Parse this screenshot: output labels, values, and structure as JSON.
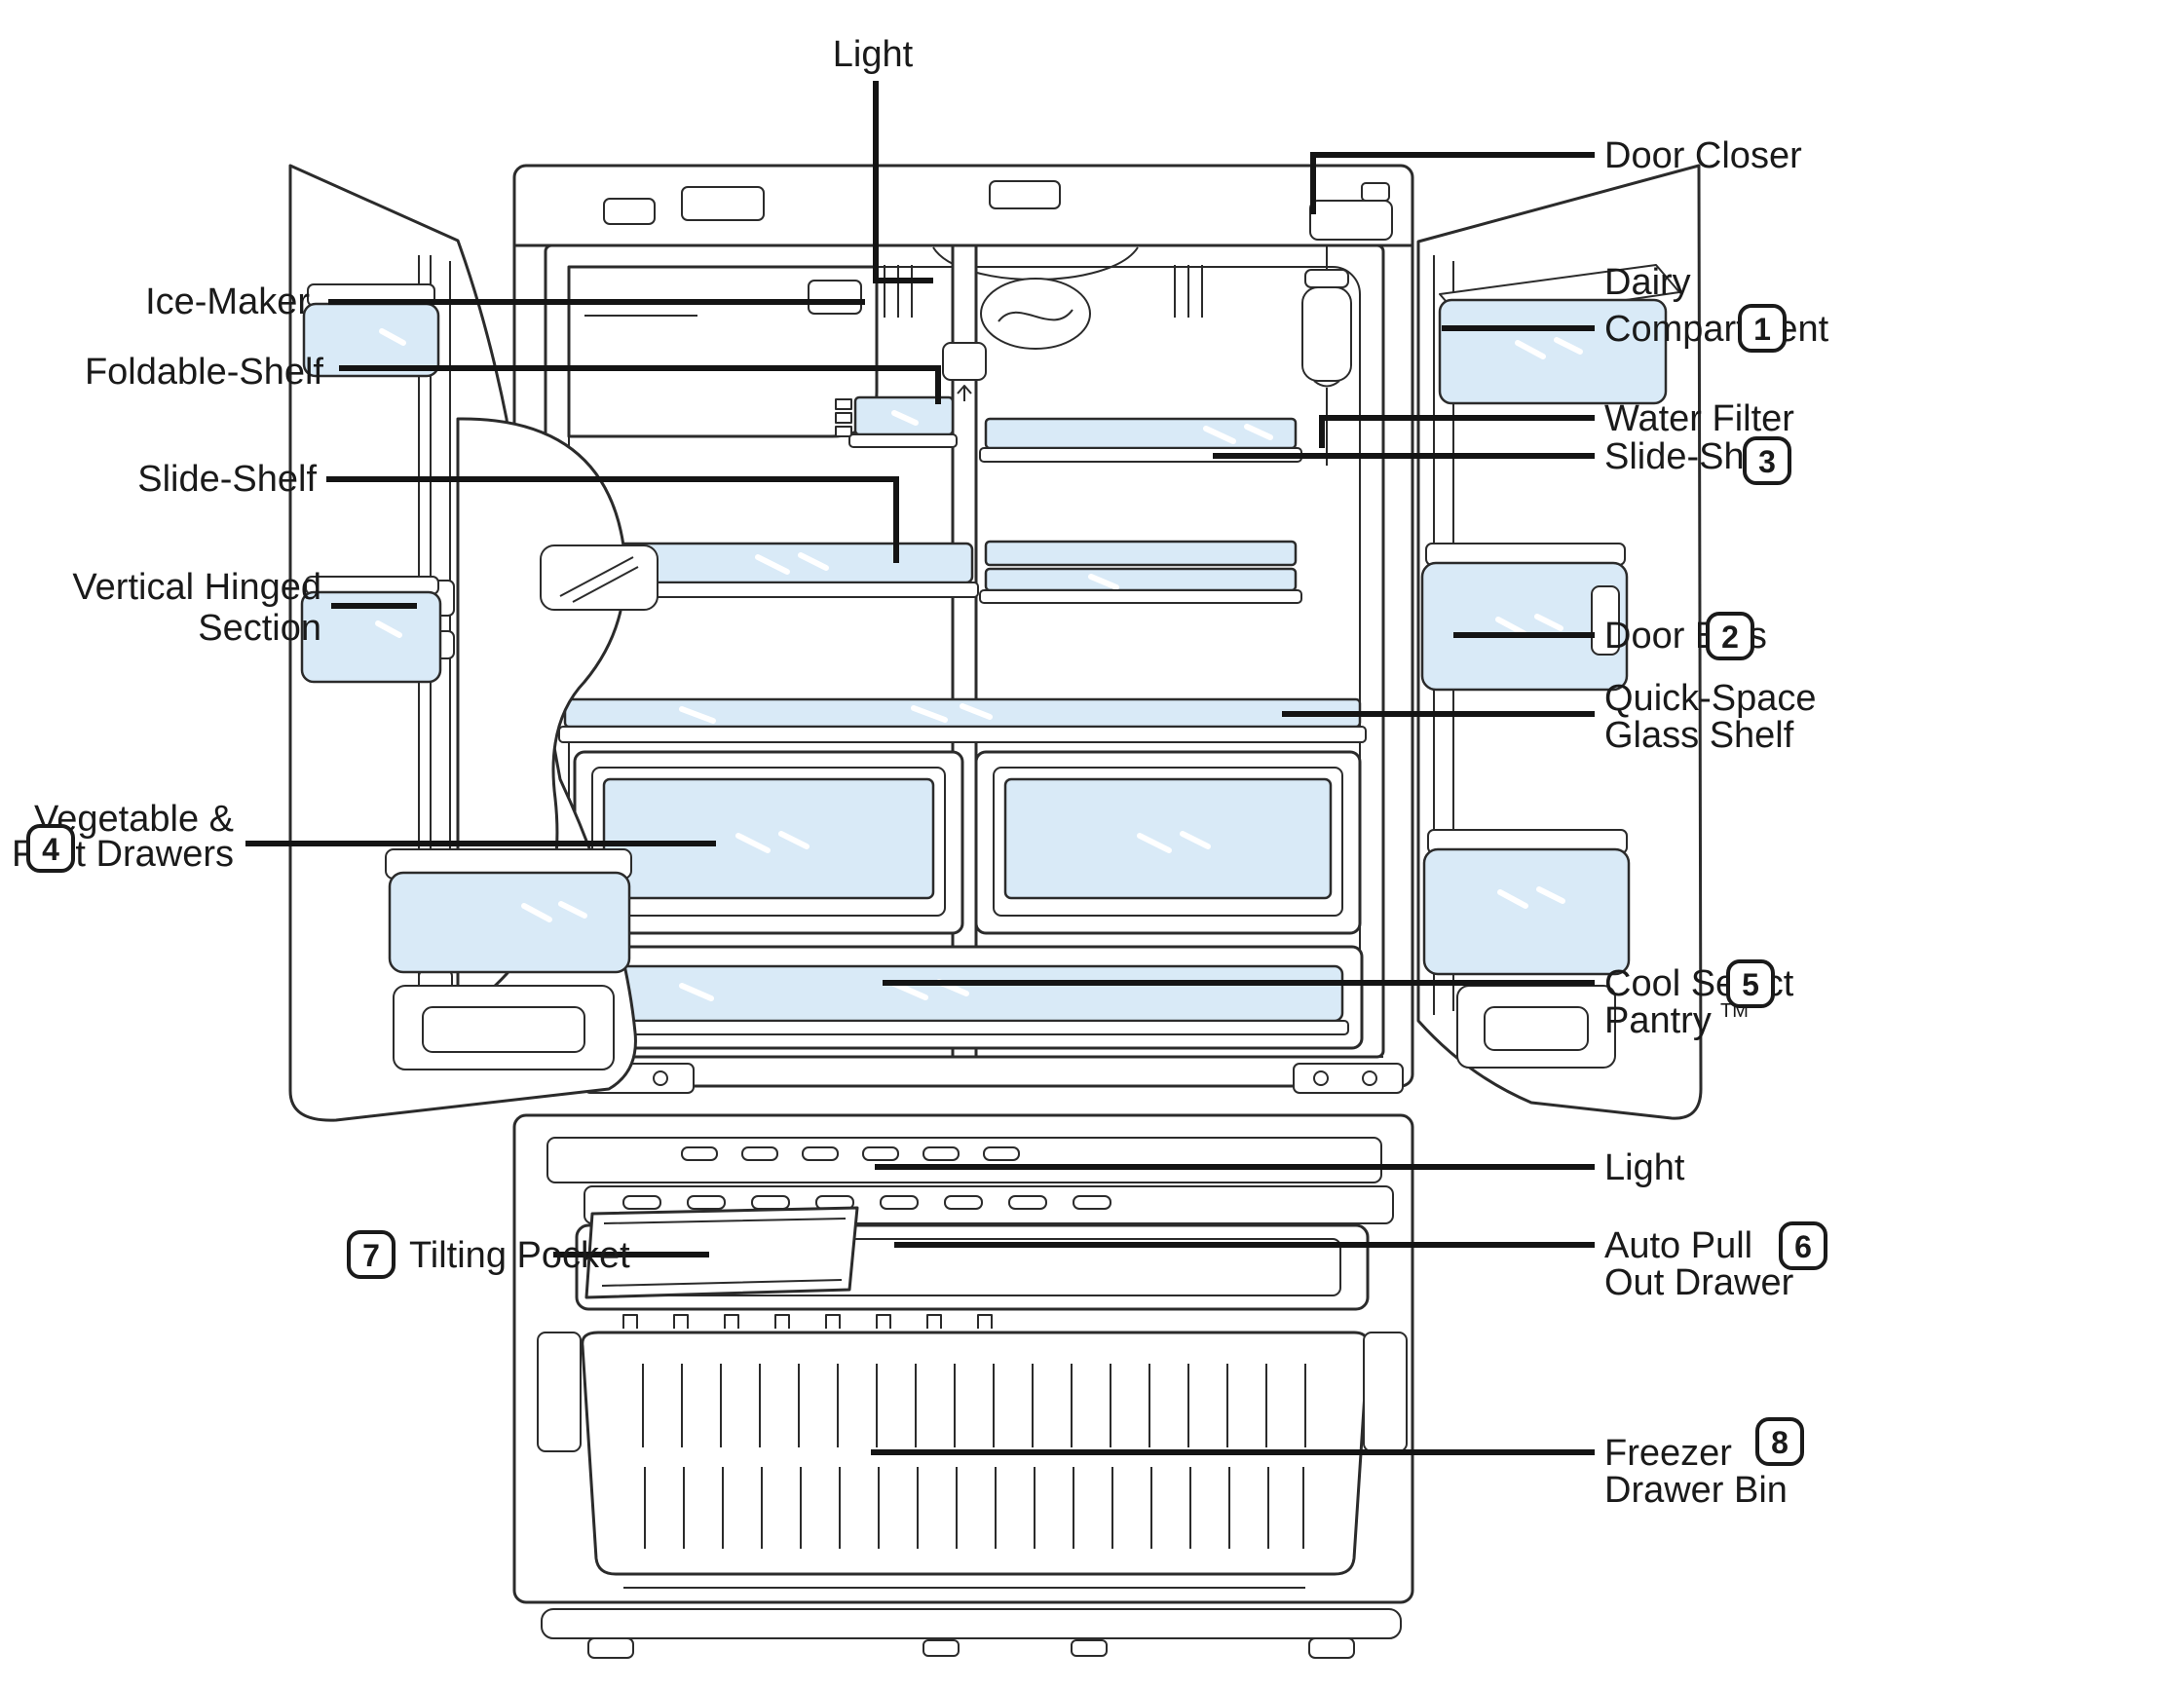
{
  "diagram": {
    "title": "refrigerator-interior-parts-diagram",
    "colors": {
      "glass": "#d9eaf7",
      "line": "#2b2b2b",
      "leader": "#141414",
      "text": "#1a1a1a"
    },
    "labels": {
      "light_top": "Light",
      "ice_maker": "Ice-Maker",
      "foldable_shelf": "Foldable-Shelf",
      "slide_shelf_left": "Slide-Shelf",
      "vertical_hinged_line1": "Vertical Hinged",
      "vertical_hinged_line2": "Section",
      "vegetable_line1": "Vegetable &",
      "vegetable_line2": "Fruit Drawers",
      "tilting_pocket": "Tilting Pocket",
      "door_closer": "Door Closer",
      "dairy_line1": "Dairy",
      "dairy_line2": "Compartment",
      "water_filter": "Water Filter",
      "slide_shelf_right": "Slide-Shelf",
      "door_bins": "Door Bins",
      "quick_space_line1": "Quick-Space",
      "quick_space_line2": "Glass Shelf",
      "cool_select_line1": "Cool Select",
      "cool_select_line2": "Pantry",
      "cool_select_tm": "TM",
      "light_bottom": "Light",
      "auto_pull_line1": "Auto Pull",
      "auto_pull_line2": "Out Drawer",
      "freezer_line1": "Freezer",
      "freezer_line2": "Drawer Bin"
    },
    "callouts": {
      "dairy_compartment": "1",
      "door_bins": "2",
      "slide_shelf": "3",
      "vegetable_fruit_drawers": "4",
      "cool_select_pantry": "5",
      "auto_pull_out_drawer": "6",
      "tilting_pocket": "7",
      "freezer_drawer_bin": "8"
    }
  }
}
